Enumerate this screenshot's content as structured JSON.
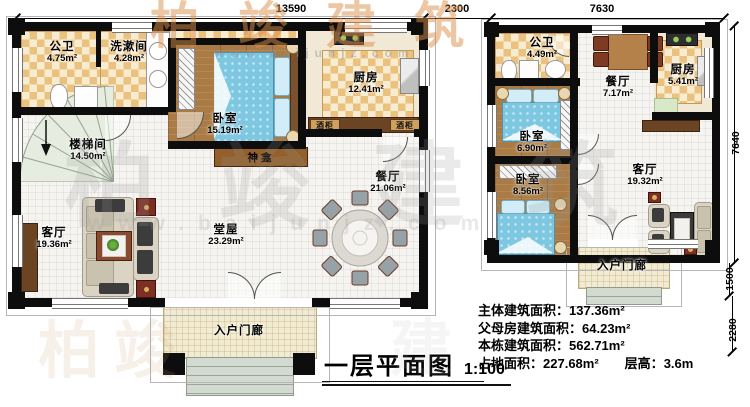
{
  "title": {
    "text": "一层平面图",
    "scale": "1:100"
  },
  "stats": [
    {
      "label": "主体建筑面积：",
      "value": "137.36m²"
    },
    {
      "label": "父母房建筑面积：",
      "value": "64.23m²"
    },
    {
      "label": "本栋建筑面积：",
      "value": "562.71m²"
    },
    {
      "label": "占地面积：",
      "value": "227.68m²"
    },
    {
      "label": "层高：",
      "value": "3.6m"
    }
  ],
  "dimensions": {
    "top_left": "13590",
    "top_gap": "2300",
    "top_right": "7630",
    "right_height": "7640",
    "porch_height": "1500",
    "steps_height": "2280"
  },
  "left_plan": {
    "rooms": [
      {
        "name": "公卫",
        "area": "4.75m²"
      },
      {
        "name": "洗漱间",
        "area": "4.28m²"
      },
      {
        "name": "卧室",
        "area": "15.19m²"
      },
      {
        "name": "厨房",
        "area": "12.41m²"
      },
      {
        "name": "楼梯间",
        "area": "14.50m²"
      },
      {
        "name": "客厅",
        "area": "19.36m²"
      },
      {
        "name": "堂屋",
        "area": "23.29m²"
      },
      {
        "name": "餐厅",
        "area": "21.06m²"
      },
      {
        "name": "入户门廊",
        "area": ""
      }
    ],
    "shrine": "神龛",
    "wine_cabinet": "酒柜"
  },
  "right_plan": {
    "rooms": [
      {
        "name": "公卫",
        "area": "4.49m²"
      },
      {
        "name": "餐厅",
        "area": "7.17m²"
      },
      {
        "name": "厨房",
        "area": "5.41m²"
      },
      {
        "name": "卧室",
        "area": "6.90m²"
      },
      {
        "name": "卧室",
        "area": "8.56m²"
      },
      {
        "name": "客厅",
        "area": "19.32m²"
      },
      {
        "name": "入户门廊",
        "area": ""
      }
    ]
  },
  "watermarks": {
    "brand_top": "柏竣建筑",
    "url_top": "www.baijunjz.com",
    "brand_mid": "柏竣建筑",
    "url_mid": "www.baijunjz.com",
    "ghost_1": "柏竣",
    "ghost_2": "建"
  }
}
